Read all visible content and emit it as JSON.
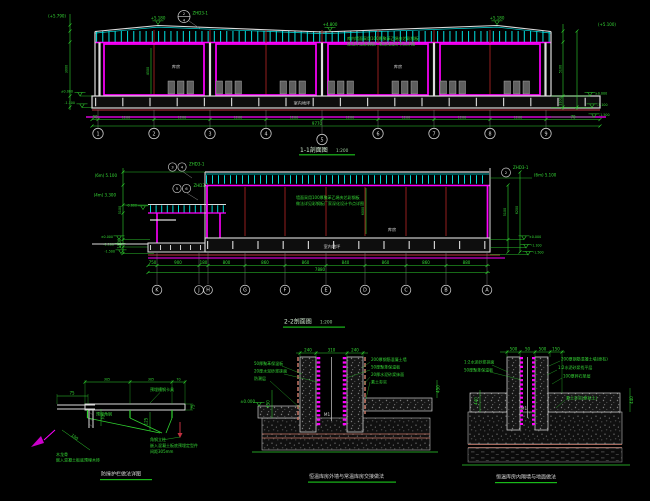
{
  "palette": {
    "background": "#000000",
    "truss_cyan": "#00DADA",
    "wall_magenta": "#FF00FF",
    "dim_green": "#2FD32F",
    "grid_red": "#A52222",
    "line_white": "#DCDCDC",
    "accent_pink": "#C03040",
    "title_underline": "#19B919"
  },
  "section_1_1": {
    "title": "1-1剖面图",
    "scale": "1:200",
    "callout": {
      "num": "2",
      "den": "4",
      "sheet": "ZHD3-1"
    },
    "roof_flags": [
      "+5.180",
      "+4.800",
      "+5.180"
    ],
    "left": {
      "top_elev": "(+5.790)",
      "elev_zero": "±0.000",
      "elev_m1": "-1.100",
      "height_dim": "3000"
    },
    "right": {
      "top_elev": "(+5.100)",
      "elev_zero": "±0.000",
      "elev_m1": "-1.100",
      "elev_m2": "-1.500",
      "dim_wall": "5100",
      "dim_base": "1100"
    },
    "door_dim": "4500",
    "notes": [
      "库内墙面采用100厚聚苯乙烯夹芯彩钢板",
      "做法详见彩钢板厂家深化设计节点详图"
    ],
    "rooms": [
      "库房",
      "库房"
    ],
    "slab_label": "室内地坪",
    "dims": [
      "90",
      "1200",
      "1200",
      "1200",
      "1200",
      "1200",
      "1200",
      "1200",
      "1200",
      "70"
    ],
    "total_dim": "9770",
    "grids": [
      "1",
      "2",
      "3",
      "4",
      "5",
      "6",
      "7",
      "8",
      "9"
    ]
  },
  "section_2_2": {
    "title": "2-2剖面图",
    "scale": "1:200",
    "callout1": {
      "num": "3",
      "den": "4",
      "sheet": "ZHD3-1"
    },
    "callout2": {
      "num": "5",
      "den": "6",
      "sheet": "ZHD3-1"
    },
    "callout3": {
      "num": "2",
      "sheet": "ZHD3-1"
    },
    "left": {
      "elev_6m": "(6m) 5.100",
      "elev_4m": "(4m) 3.300",
      "elev_zero": "±0.000",
      "elev_m1": "-1.100",
      "elev_m2": "-1.500",
      "dim_wall": "5100",
      "dim_base": "1100"
    },
    "canopy_elev": "-0.600",
    "right": {
      "top_elev": "(6m) 5.100",
      "elev_zero": "±0.000",
      "elev_m1": "-1.100",
      "elev_m2": "-1.500",
      "dim_wall": "5100",
      "dim_total": "6200"
    },
    "interior_dim": "6000",
    "room": "库房",
    "slab_label": "室内地坪",
    "notes": [
      "墙面采用100厚聚苯乙烯夹芯彩钢板",
      "做法详见彩钢板厂家深化设计节点详图"
    ],
    "dims": [
      "750",
      "900",
      "180",
      "800",
      "860",
      "860",
      "840",
      "860",
      "860",
      "880"
    ],
    "total_dim": "7880",
    "grids": [
      "K",
      "J",
      "H",
      "G",
      "F",
      "E",
      "D",
      "C",
      "B",
      "A"
    ]
  },
  "detail_rail": {
    "dims_top": [
      "305",
      "305",
      "70"
    ],
    "dim_75": "75",
    "dim_125": "125",
    "sub": {
      "dim_75": "75",
      "dim_70": "70",
      "dim_100": "100",
      "label": "预埋角钢",
      "notes": [
        "木龙骨",
        "嵌入混凝土板底预埋木砖"
      ]
    },
    "label_clamp": "预埋槽钢卡具",
    "notes": [
      "角钢立柱",
      "嵌入混凝土板底预埋定型件",
      "间距305mm"
    ],
    "title": "防撞护栏做法详图"
  },
  "detail_wall": {
    "dims_top": [
      "240",
      "310",
      "240"
    ],
    "left_notes": [
      "50厚聚苯保温板",
      "20厚水泥砂浆抹面",
      "防潮层"
    ],
    "right_notes": [
      "200厚钢筋混凝土墙",
      "50厚聚苯保温板",
      "20厚水泥砂浆抹面",
      "素土夯实"
    ],
    "dim_left": "450",
    "dim_right": "450",
    "elev_zero": "±0.000",
    "wall_mark": "M1",
    "title": "恒温库房外墙与常温库房交接做法"
  },
  "detail_floor": {
    "dims_top": [
      "500",
      "50",
      "500",
      "150"
    ],
    "left_notes": [
      "1:2水泥砂浆抹面",
      "50厚聚苯保温板"
    ],
    "right_notes": [
      "200厚钢筋混凝土墙(原有)",
      "1:2水泥砂浆找平层",
      "100厚碎石垫层",
      "素土夯实(原状土)"
    ],
    "dim_left": "440",
    "dim_right": "440",
    "wall_mark": "M1",
    "title": "恒温库房内隔墙与地面做法"
  }
}
